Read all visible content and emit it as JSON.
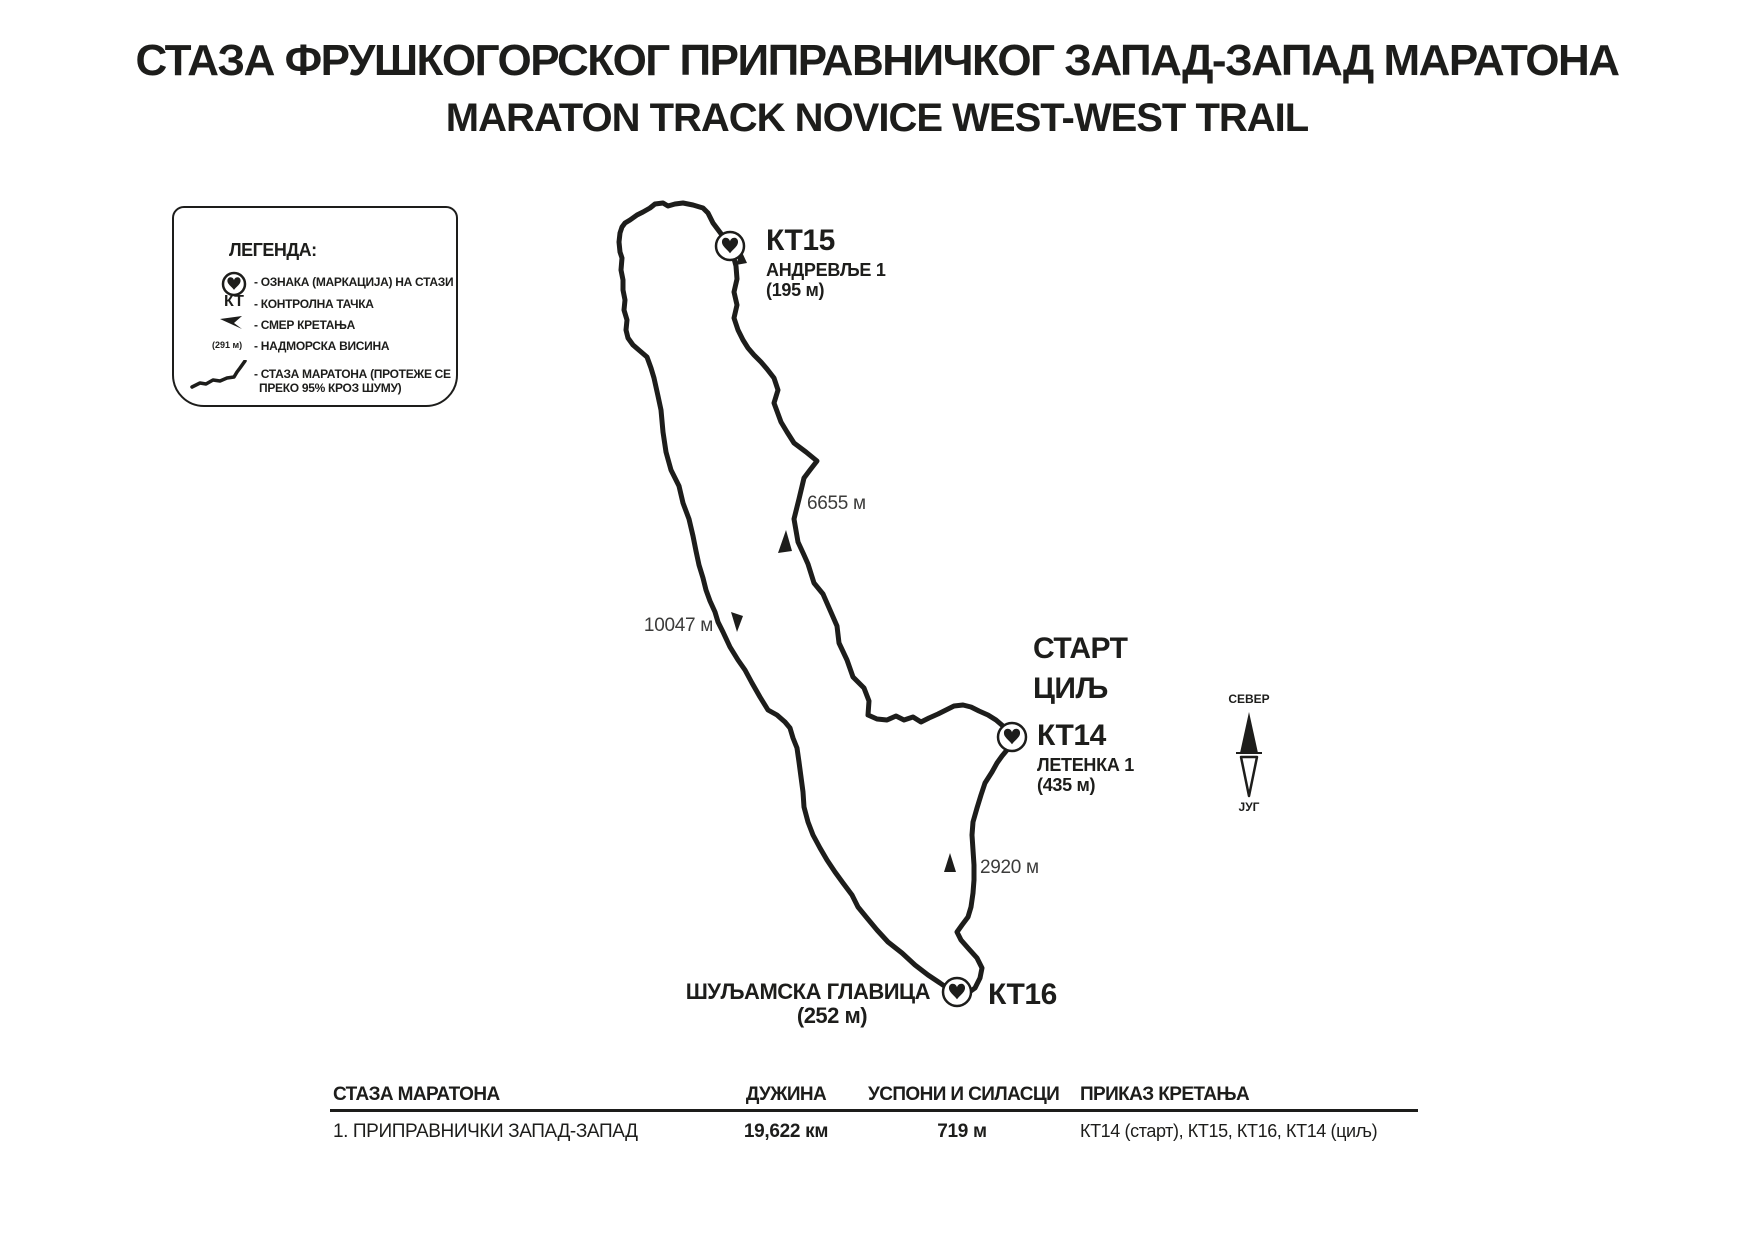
{
  "title": {
    "line1": "СТАЗА ФРУШКОГОРСКОГ ПРИПРАВНИЧКОГ ЗАПАД-ЗАПАД МАРАТОНА",
    "line2": "MARATON TRACK NOVICE WEST-WEST TRAIL"
  },
  "legend": {
    "heading": "ЛЕГЕНДА:",
    "items": {
      "marker": {
        "icon": "heart-marker-icon",
        "label": "- ОЗНАКА (МАРКАЦИЈА) НА СТАЗИ"
      },
      "checkpoint": {
        "symbol": "КТ",
        "label": "- КОНТРОЛНА ТАЧКА"
      },
      "direction": {
        "icon": "direction-arrow-icon",
        "label": "- СМЕР КРЕТАЊА"
      },
      "elevation": {
        "symbol": "(291 м)",
        "label": "- НАДМОРСКА ВИСИНА"
      },
      "trail": {
        "icon": "trail-line-icon",
        "label_line1": "- СТАЗА МАРАТОНА (ПРОТЕЖЕ СЕ",
        "label_line2": "ПРЕКО 95% КРОЗ ШУМУ)"
      }
    }
  },
  "map": {
    "checkpoints": {
      "kt15": {
        "id": "КТ15",
        "place": "АНДРЕВЉЕ 1",
        "elevation": "(195 м)"
      },
      "kt14": {
        "id": "КТ14",
        "place": "ЛЕТЕНКА 1",
        "elevation": "(435 м)"
      },
      "kt16": {
        "id": "КТ16",
        "place": "ШУЉАМСКА ГЛАВИЦА",
        "elevation": "(252 м)"
      }
    },
    "start_finish": {
      "line1": "СТАРТ",
      "line2": "ЦИЉ"
    },
    "distance_labels": {
      "kt14_kt15": "6655 м",
      "kt15_kt16": "10047 м",
      "kt16_kt14": "2920 м"
    },
    "compass": {
      "north": "СЕВЕР",
      "south": "ЈУГ"
    }
  },
  "table": {
    "headers": {
      "track": "СТАЗА МАРАТОНА",
      "length": "ДУЖИНА",
      "ascents": "УСПОНИ И СИЛАСЦИ",
      "movement": "ПРИКАЗ КРЕТАЊА"
    },
    "row": {
      "track": "1. ПРИПРАВНИЧКИ ЗАПАД-ЗАПАД",
      "length": "19,622 км",
      "ascents": "719 м",
      "movement": "КТ14 (старт), КТ15, КТ16, КТ14 (циљ)"
    }
  },
  "colors": {
    "ink": "#1d1d1b",
    "muted_text": "#3c3c3b",
    "background": "#ffffff"
  }
}
